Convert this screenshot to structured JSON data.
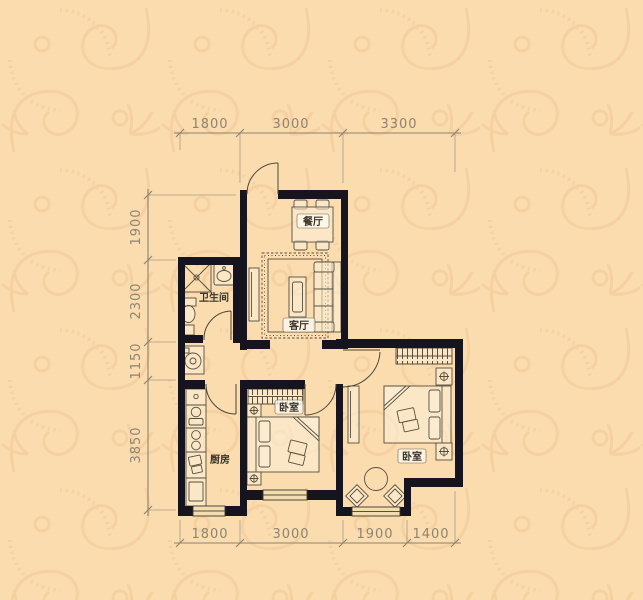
{
  "plan": {
    "title": "two-bedroom apartment floor plan",
    "rooms": {
      "dining": "餐厅",
      "living": "客厅",
      "bathroom": "卫生间",
      "kitchen": "厨房",
      "bedroom_middle": "卧室",
      "bedroom_right": "卧室"
    },
    "dimensions": {
      "top": [
        "1800",
        "3000",
        "3300"
      ],
      "left": [
        "1900",
        "2300",
        "1150",
        "3850"
      ],
      "bottom": [
        "1800",
        "3000",
        "1900",
        "1400"
      ]
    },
    "colors": {
      "background": "#fbdcae",
      "wallpaper_pattern": "#f0c493",
      "walls": "#16151f",
      "furniture_line": "#57503f",
      "dimension_text": "#8e8473",
      "room_label_text": "#38342b"
    }
  }
}
